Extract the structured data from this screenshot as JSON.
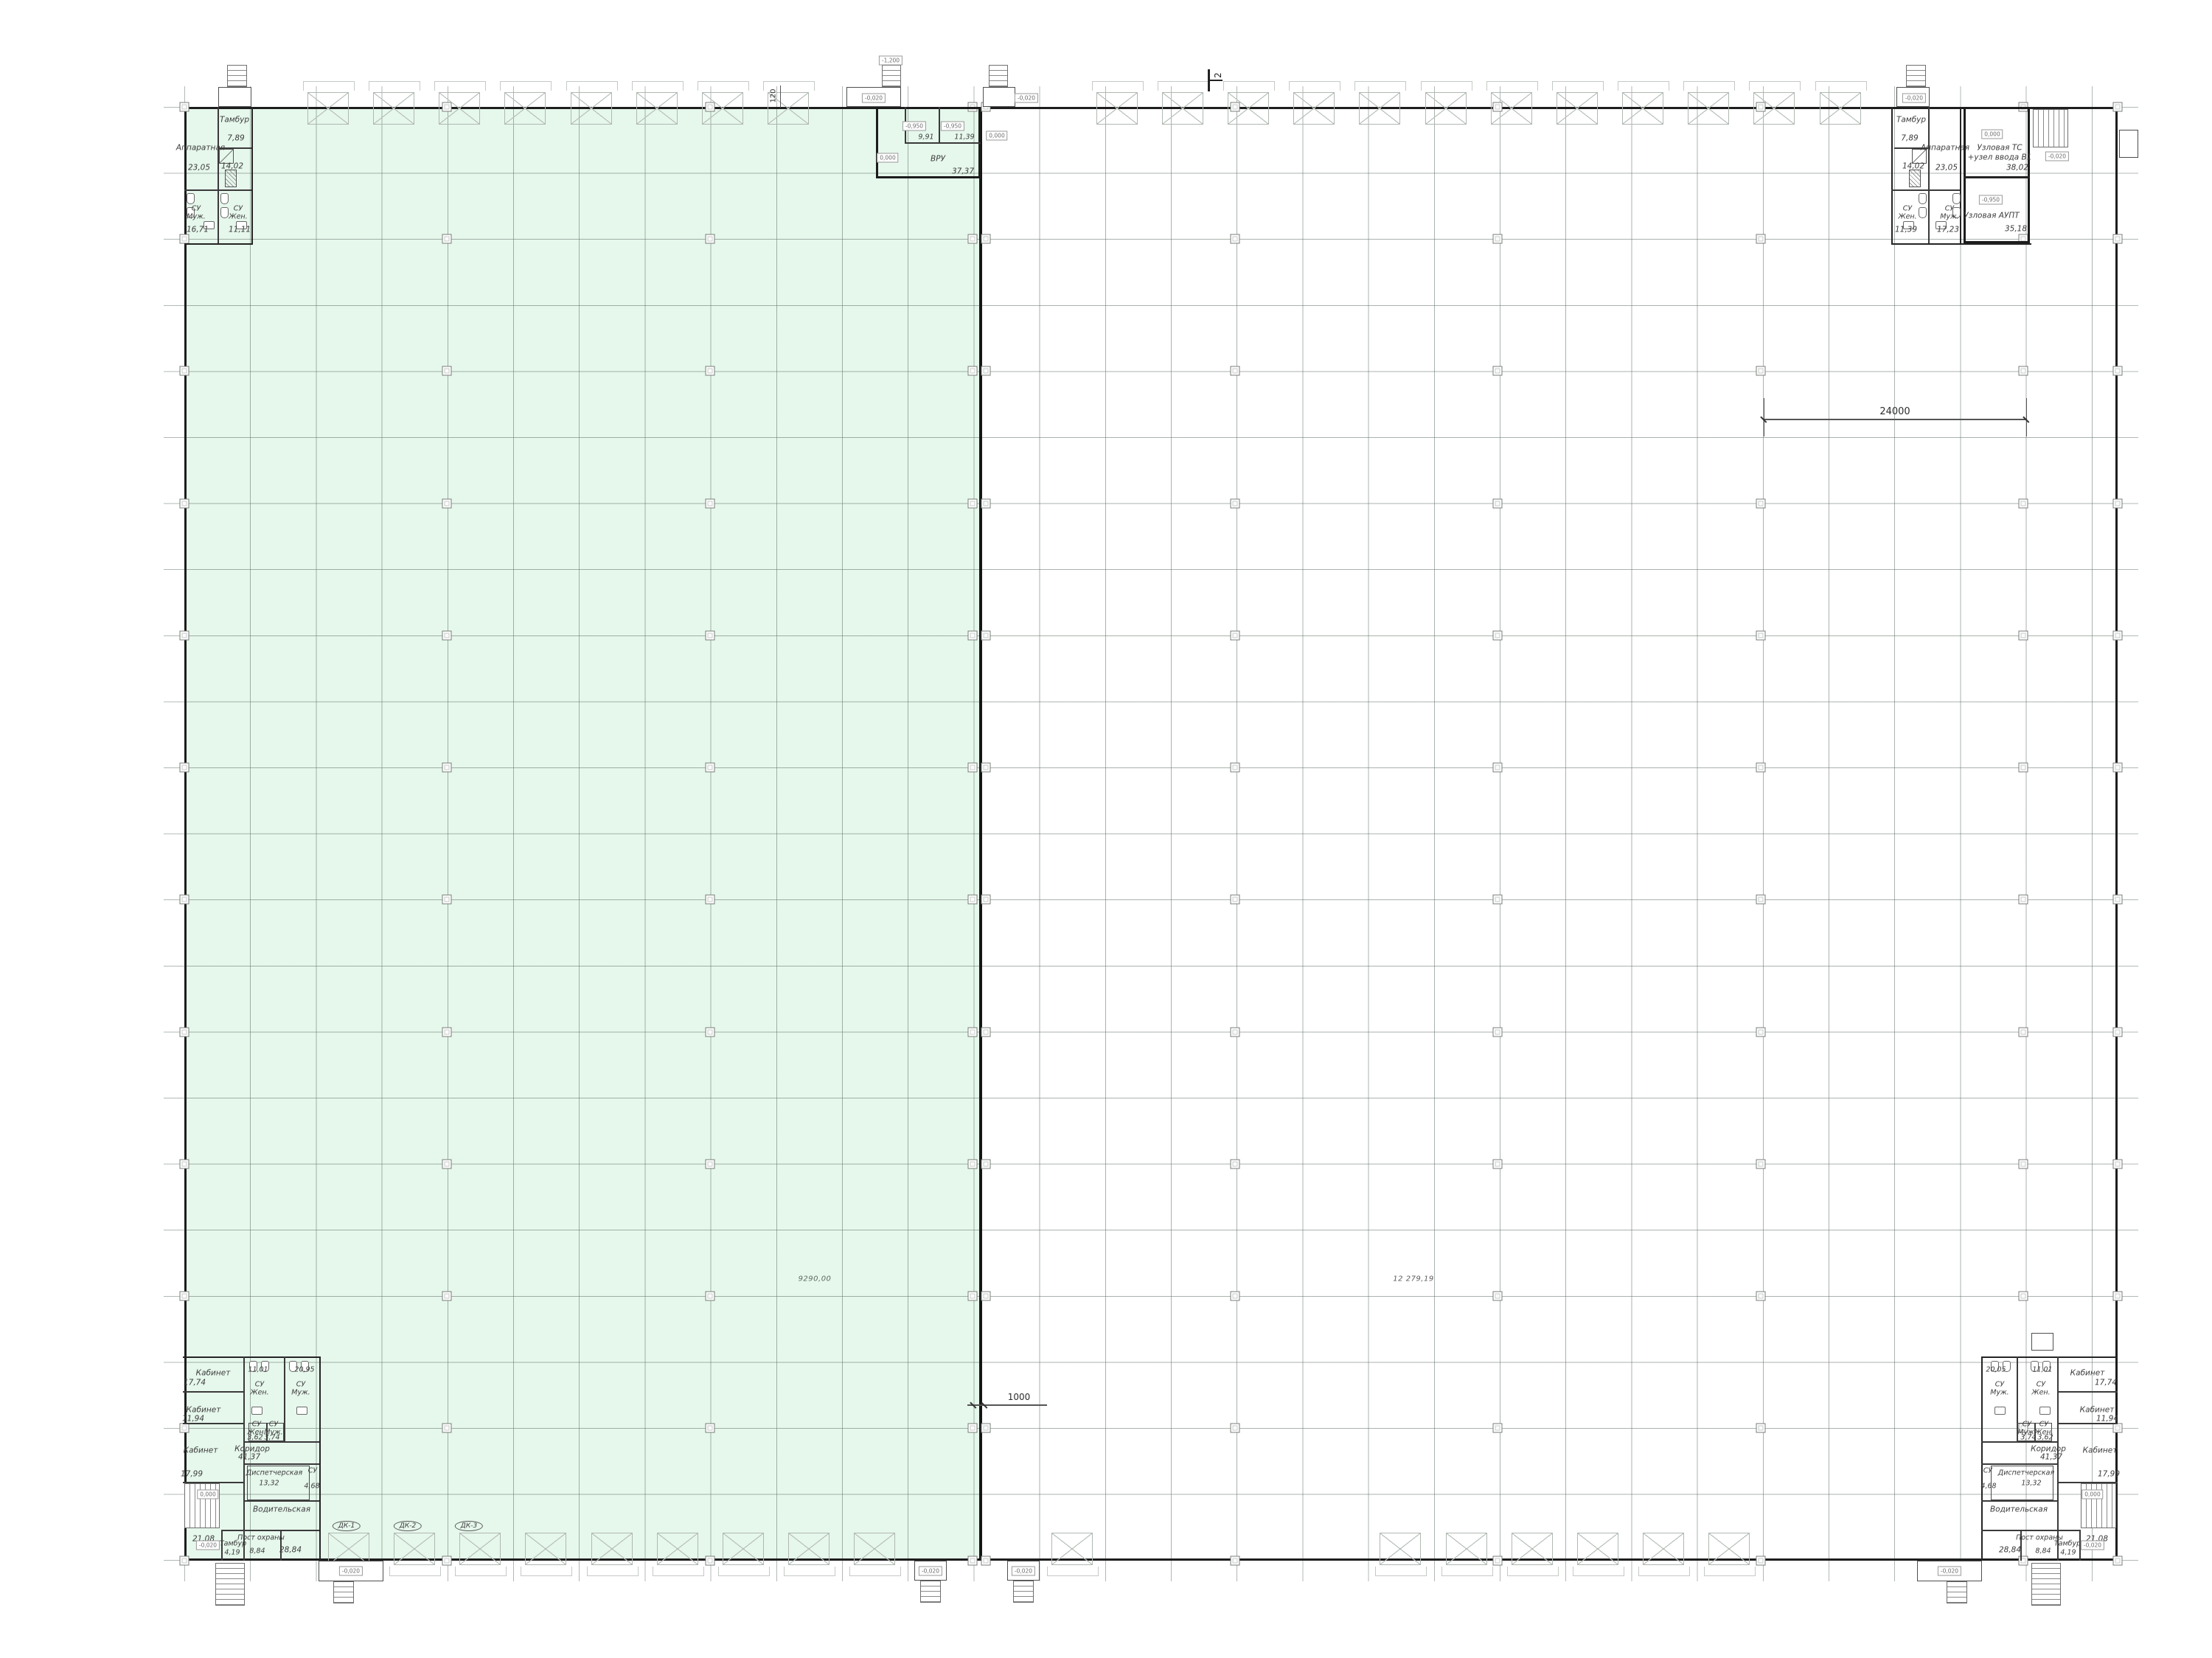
{
  "labels": {
    "area_left": "9290,00",
    "area_right": "12 279,19",
    "dim_main": "24000",
    "dim_small": "1000",
    "dim_side": "120",
    "section": "2",
    "dock_tags": [
      "ДК-1",
      "ДК-2",
      "ДК-3"
    ]
  },
  "elev": {
    "zero": "0,000",
    "low": "-0,020",
    "pit": "-0,950",
    "ramp": "-1,200"
  },
  "tl": {
    "rooms": [
      {
        "n": "Тамбур",
        "a": "7,89"
      },
      {
        "n": "Аппаратная",
        "a": "23,05"
      },
      {
        "n": "",
        "a": "14,02"
      },
      {
        "n": "СУ\nМуж.",
        "a": "16,71"
      },
      {
        "n": "СУ\nЖен.",
        "a": "11,11"
      }
    ]
  },
  "tc": {
    "rooms": [
      {
        "n": "ТП",
        "a": "9,91"
      },
      {
        "n": "ТП",
        "a": "11,39"
      },
      {
        "n": "ВРУ",
        "a": "37,37"
      }
    ]
  },
  "tr": {
    "rooms": [
      {
        "n": "Тамбур",
        "a": "7,89"
      },
      {
        "n": "Аппаратная",
        "a": "23,05"
      },
      {
        "n": "",
        "a": "14,02"
      },
      {
        "n": "СУ\nЖен.",
        "a": "11,39"
      },
      {
        "n": "СУ\nМуж.",
        "a": "17,23"
      },
      {
        "n": "Узловая ТС\n+узел ввода В1",
        "a": "38,02"
      },
      {
        "n": "Узловая АУПТ",
        "a": "35,18"
      }
    ]
  },
  "bl": {
    "rooms": [
      {
        "n": "Кабинет",
        "a": "17,74"
      },
      {
        "n": "Кабинет",
        "a": "11,94"
      },
      {
        "n": "Кабинет",
        "a": "17,99"
      },
      {
        "n": "СУ\nЖен.",
        "a": "11,01"
      },
      {
        "n": "СУ\nМуж.",
        "a": "20,95"
      },
      {
        "n": "СУ\nЖен.",
        "a": "3,62"
      },
      {
        "n": "СУ\nМуж.",
        "a": "3,74"
      },
      {
        "n": "Коридор",
        "a": "41,37"
      },
      {
        "n": "Диспетчерская",
        "a": "13,32"
      },
      {
        "n": "СУ",
        "a": "4,68"
      },
      {
        "n": "Водительская",
        "a": "28,84"
      },
      {
        "n": "Пост охраны",
        "a": "8,84"
      },
      {
        "n": "Тамбур",
        "a": "4,19"
      },
      {
        "n": "",
        "a": "21,08"
      }
    ]
  },
  "br": {
    "rooms": [
      {
        "n": "Кабинет",
        "a": "17,74"
      },
      {
        "n": "Кабинет",
        "a": "11,94"
      },
      {
        "n": "Кабинет",
        "a": "17,99"
      },
      {
        "n": "СУ\nМуж.",
        "a": "20,05"
      },
      {
        "n": "СУ\nЖен.",
        "a": "11,01"
      },
      {
        "n": "СУ\nМуж.",
        "a": "3,74"
      },
      {
        "n": "СУ\nЖен.",
        "a": "3,62"
      },
      {
        "n": "Коридор",
        "a": "41,37"
      },
      {
        "n": "Диспетчерская",
        "a": "13,32"
      },
      {
        "n": "СУ",
        "a": "4,68"
      },
      {
        "n": "Водительская",
        "a": "28,84"
      },
      {
        "n": "Пост охраны",
        "a": "8,84"
      },
      {
        "n": "Тамбур",
        "a": "4,19"
      },
      {
        "n": "",
        "a": "21,08"
      }
    ]
  }
}
